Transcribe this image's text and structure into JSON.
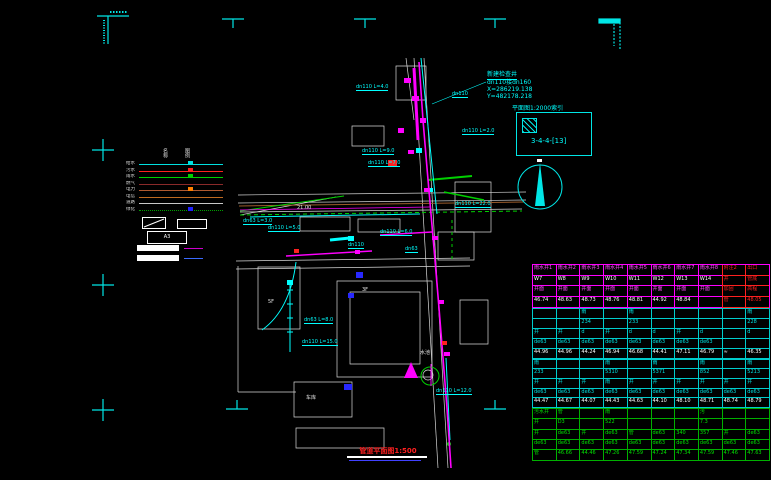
{
  "title": {
    "text": "管道平面图1:500"
  },
  "detail_box": {
    "caption": "平面图1:2000索引",
    "code": "3-4-4-[13]"
  },
  "map": {
    "callout": {
      "name": "新建检查井",
      "pipe": "dn110接dn160",
      "x": "X=286219.138",
      "y": "Y=482178.218"
    },
    "labels": [
      {
        "x": 356,
        "y": 85,
        "t": "dn110 L=4.0"
      },
      {
        "x": 452,
        "y": 92,
        "t": "dn110"
      },
      {
        "x": 462,
        "y": 129,
        "t": "dn110 L=2.0"
      },
      {
        "x": 362,
        "y": 149,
        "t": "dn110 L=9.0"
      },
      {
        "x": 368,
        "y": 161,
        "t": "dn110 L=7.0"
      },
      {
        "x": 243,
        "y": 219,
        "t": "dn63 L=3.0"
      },
      {
        "x": 268,
        "y": 226,
        "t": "dn110 L=5.0"
      },
      {
        "x": 380,
        "y": 230,
        "t": "dn110 L=6.0"
      },
      {
        "x": 455,
        "y": 202,
        "t": "dn110 L=22.0"
      },
      {
        "x": 348,
        "y": 243,
        "t": "dn110"
      },
      {
        "x": 405,
        "y": 247,
        "t": "dn63"
      },
      {
        "x": 304,
        "y": 318,
        "t": "dn63 L=8.0"
      },
      {
        "x": 302,
        "y": 340,
        "t": "dn110 L=15.0"
      },
      {
        "x": 436,
        "y": 389,
        "t": "dn110 L=12.0"
      }
    ],
    "white_labels": [
      {
        "x": 297,
        "y": 206,
        "t": "21.00"
      },
      {
        "x": 420,
        "y": 351,
        "t": "水池"
      },
      {
        "x": 362,
        "y": 288,
        "t": "3F"
      },
      {
        "x": 268,
        "y": 300,
        "t": "5F"
      },
      {
        "x": 306,
        "y": 396,
        "t": "车库"
      }
    ]
  },
  "legend": {
    "headers": [
      "名称",
      "图例"
    ],
    "a3_label": "A3",
    "items": [
      {
        "label": "给水",
        "color": "#00e0e0",
        "mark": "#00e0e0",
        "dotted": false
      },
      {
        "label": "污水",
        "color": "#ff2020",
        "mark": "#ff2020",
        "dotted": false
      },
      {
        "label": "雨水",
        "color": "#00d000",
        "mark": "#00d000",
        "dotted": false
      },
      {
        "label": "燃气",
        "color": "#8a2a2a",
        "mark": "",
        "dotted": false
      },
      {
        "label": "电力",
        "color": "#b05a30",
        "mark": "#ff8000",
        "dotted": false
      },
      {
        "label": "电信",
        "color": "#c06a20",
        "mark": "",
        "dotted": false
      },
      {
        "label": "道路",
        "color": "#c8c8c8",
        "mark": "",
        "dotted": false
      },
      {
        "label": "绿化",
        "color": "#00a000",
        "mark": "#2020ff",
        "dotted": true
      }
    ]
  },
  "table": {
    "sections": [
      {
        "border": "#ff00ff",
        "red_cols": [
          8,
          9
        ],
        "red_border": "#ff2020",
        "row_h": 8.7,
        "rows": [
          {
            "color": "#ff50ff",
            "cells": [
              "雨水井1",
              "雨水井2",
              "雨水井3",
              "雨水井4",
              "雨水井5",
              "雨水井6",
              "雨水井7",
              "雨水井8",
              "附注2",
              "出口"
            ]
          },
          {
            "color": "#ffffff",
            "cells": [
              "W7",
              "W8",
              "W9",
              "W10",
              "W11",
              "W12",
              "W13",
              "W14",
              "井",
              "管底"
            ]
          },
          {
            "color": "#ff50ff",
            "cells": [
              "井面",
              "井面",
              "井面",
              "井面",
              "井面",
              "井面",
              "井面",
              "井面",
              "加固",
              "高程"
            ]
          },
          {
            "color": "#ffffff",
            "cells": [
              "46.74",
              "48.63",
              "48.73",
              "48.76",
              "48.81",
              "44.92",
              "48.84",
              "",
              "管",
              "48.05"
            ]
          }
        ]
      },
      {
        "border": "#00cccc",
        "red_cols": [],
        "red_border": "",
        "row_h": 8.0,
        "rows": [
          {
            "color": "#00e0e0",
            "cells": [
              "",
              "",
              "雨",
              "",
              "雨",
              "",
              "",
              "",
              "",
              "雨"
            ]
          },
          {
            "color": "#00e0e0",
            "cells": [
              "",
              "",
              "234",
              "",
              "233",
              "",
              "",
              "",
              "",
              "228"
            ]
          },
          {
            "color": "#00e0e0",
            "cells": [
              "井",
              "井",
              "d",
              "井",
              "d",
              "d",
              "井",
              "d",
              "",
              "d"
            ]
          },
          {
            "color": "#00e0e0",
            "cells": [
              "de63",
              "de63",
              "de63",
              "de63",
              "de63",
              "de63",
              "de63",
              "de63",
              "",
              ""
            ]
          },
          {
            "color": "#ffffff",
            "cells": [
              "44.96",
              "44.96",
              "44.24",
              "46.94",
              "46.68",
              "44.41",
              "47.11",
              "46.79",
              "≈",
              "46.35"
            ]
          }
        ]
      },
      {
        "border": "#00cccc",
        "red_cols": [],
        "red_border": "",
        "row_h": 7.6,
        "rows": [
          {
            "color": "#00e0e0",
            "cells": [
              "雨",
              "",
              "",
              "雨",
              "",
              "雨",
              "",
              "雨",
              "",
              "雨"
            ]
          },
          {
            "color": "#00e0e0",
            "cells": [
              "233",
              "",
              "",
              "5310",
              "",
              "5371",
              "",
              "852",
              "",
              "5213"
            ]
          },
          {
            "color": "#00e0e0",
            "cells": [
              "井",
              "井",
              "井",
              "雨",
              "井",
              "井",
              "井",
              "井",
              "井",
              "井"
            ]
          },
          {
            "color": "#00e0e0",
            "cells": [
              "de63",
              "de63",
              "de63",
              "de63",
              "de63",
              "de63",
              "de63",
              "de63",
              "de63",
              "de63"
            ]
          },
          {
            "color": "#ffffff",
            "cells": [
              "44.47",
              "44.67",
              "44.07",
              "44.43",
              "44.63",
              "44.10",
              "48.10",
              "48.71",
              "48.74",
              "48.79"
            ]
          }
        ]
      },
      {
        "border": "#00b000",
        "red_cols": [],
        "red_border": "",
        "row_h": 8.4,
        "rows": [
          {
            "color": "#00e000",
            "cells": [
              "污水井",
              "管",
              "",
              "雨",
              "",
              "",
              "",
              "污",
              "",
              ""
            ]
          },
          {
            "color": "#00e000",
            "cells": [
              "井",
              "D3",
              "",
              "522",
              "",
              "",
              "",
              "7.3",
              "",
              ""
            ]
          },
          {
            "color": "#00e000",
            "cells": [
              "井",
              "de63",
              "井",
              "de63",
              "管",
              "de63",
              "340",
              "357",
              "井",
              "de63"
            ]
          },
          {
            "color": "#00e000",
            "cells": [
              "de63",
              "de63",
              "de63",
              "de63",
              "de63",
              "de63",
              "de63",
              "de63",
              "de63",
              "de63"
            ]
          },
          {
            "color": "#00e000",
            "cells": [
              "管",
              "46.66",
              "44.46",
              "47.26",
              "47.59",
              "47.24",
              "47.34",
              "47.59",
              "47.46",
              "47.63"
            ]
          }
        ]
      }
    ]
  }
}
